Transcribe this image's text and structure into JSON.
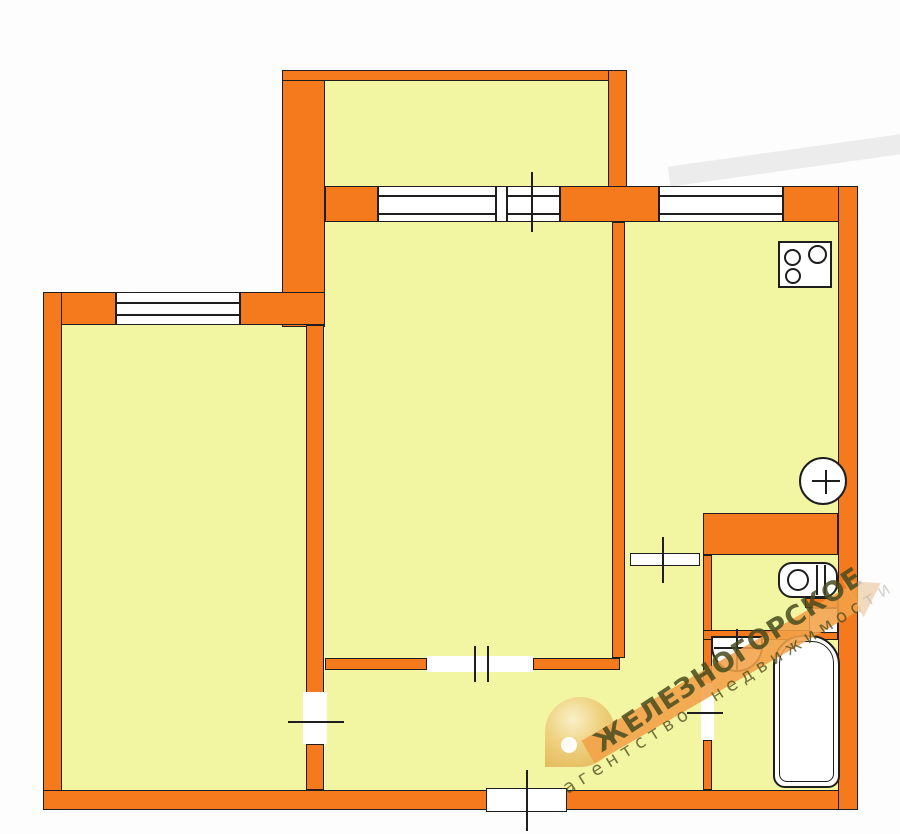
{
  "watermark": {
    "agency_title": "ЖЕЛЕЗНОГОРСКОЕ",
    "agency_subtitle": "агентство недвижимости",
    "logo_icon": "gold-map-pin-icon",
    "arrow_icon": "orange-diagonal-arrow-icon"
  },
  "colors": {
    "wall_orange": "#F5791D",
    "room_yellow": "#F2F5A2",
    "outline": "#1E1E1E",
    "opening_white": "#FFFFFF",
    "watermark_olive": "#4B4D20",
    "watermark_arrow": "#F3A048",
    "logo_gold": "#E6BC5D"
  },
  "fixtures": {
    "stove_burner_count": 3,
    "icons": [
      "stove-icon",
      "kitchen-sink-icon",
      "toilet-icon",
      "washbasin-icon",
      "bathtub-icon",
      "vent-duct-icon"
    ]
  },
  "openings": {
    "window_count": 3,
    "interior_door_count": 5,
    "entrance_door_count": 1
  }
}
